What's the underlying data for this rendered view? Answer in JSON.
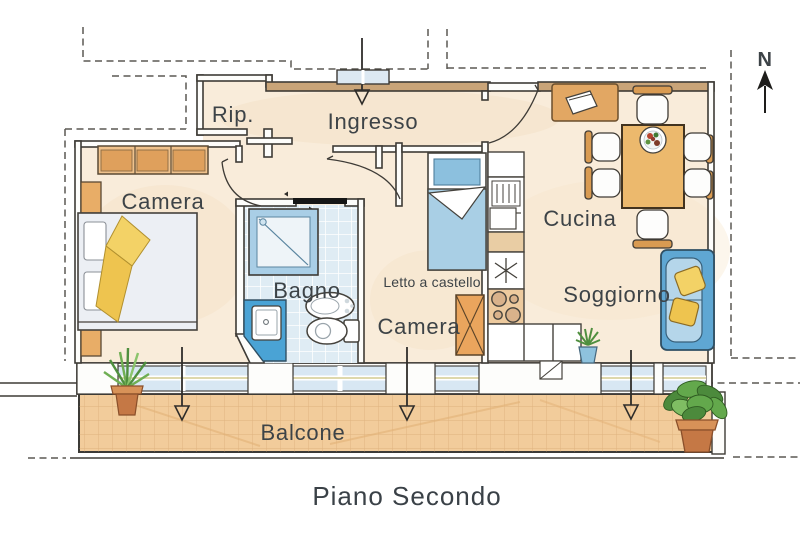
{
  "plan": {
    "title": "Piano Secondo",
    "north_label": "N",
    "labels": {
      "rip": "Rip.",
      "ingresso": "Ingresso",
      "camera1": "Camera",
      "bagno": "Bagno",
      "letto_a_castello": "Letto a castello",
      "camera2": "Camera",
      "cucina": "Cucina",
      "soggiorno": "Soggiorno",
      "balcone": "Balcone"
    },
    "colors": {
      "floor_cream": "#f9ecda",
      "wall_tan": "#c9a478",
      "outline_dark": "#3e3b36",
      "text_dark": "#3d4347",
      "tile_blue": "#dfecf4",
      "fixture_blue": "#4aa3d5",
      "window_glass": "#d8e7f3",
      "wood_orange": "#e8ad67",
      "blanket_yellow": "#f3d266",
      "sofa_blue": "#5fa7d3",
      "balcony_floor": "#f2cc9b",
      "plant_green": "#63a84c",
      "pot_terracotta": "#c57845"
    }
  }
}
